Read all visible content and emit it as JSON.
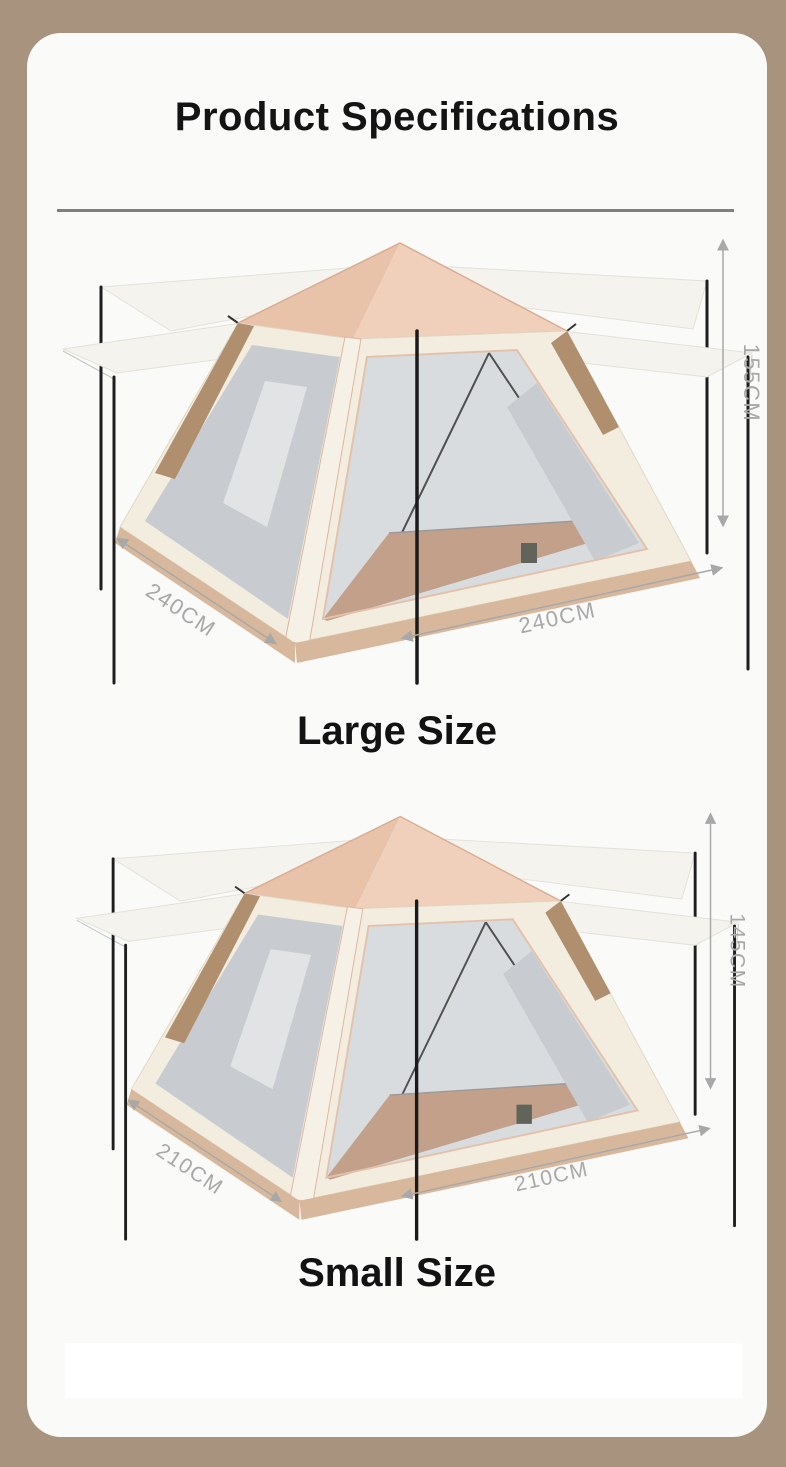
{
  "header": {
    "title": "Product Specifications"
  },
  "tents": [
    {
      "name": "Large Size",
      "height": "155CM",
      "width_left": "240CM",
      "width_right": "240CM"
    },
    {
      "name": "Small Size",
      "height": "145CM",
      "width_left": "210CM",
      "width_right": "210CM"
    }
  ],
  "colors": {
    "page_background": "#a8937e",
    "card_background": "#fafaf9",
    "divider": "#7f7f7f",
    "heading_text": "#141414",
    "dimension_text": "#a8a8a8",
    "roof": "#f0d0ba",
    "roof_shade": "#e8c2a9",
    "canopy": "#f4f3ee",
    "body": "#f3ede0",
    "mesh": "#c8ccd0",
    "interior": "#d9dcde",
    "floor": "#c3a08a",
    "skirt": "#d8b89c",
    "pole": "#1e1e1e",
    "accent_brown": "#b08f6e"
  }
}
